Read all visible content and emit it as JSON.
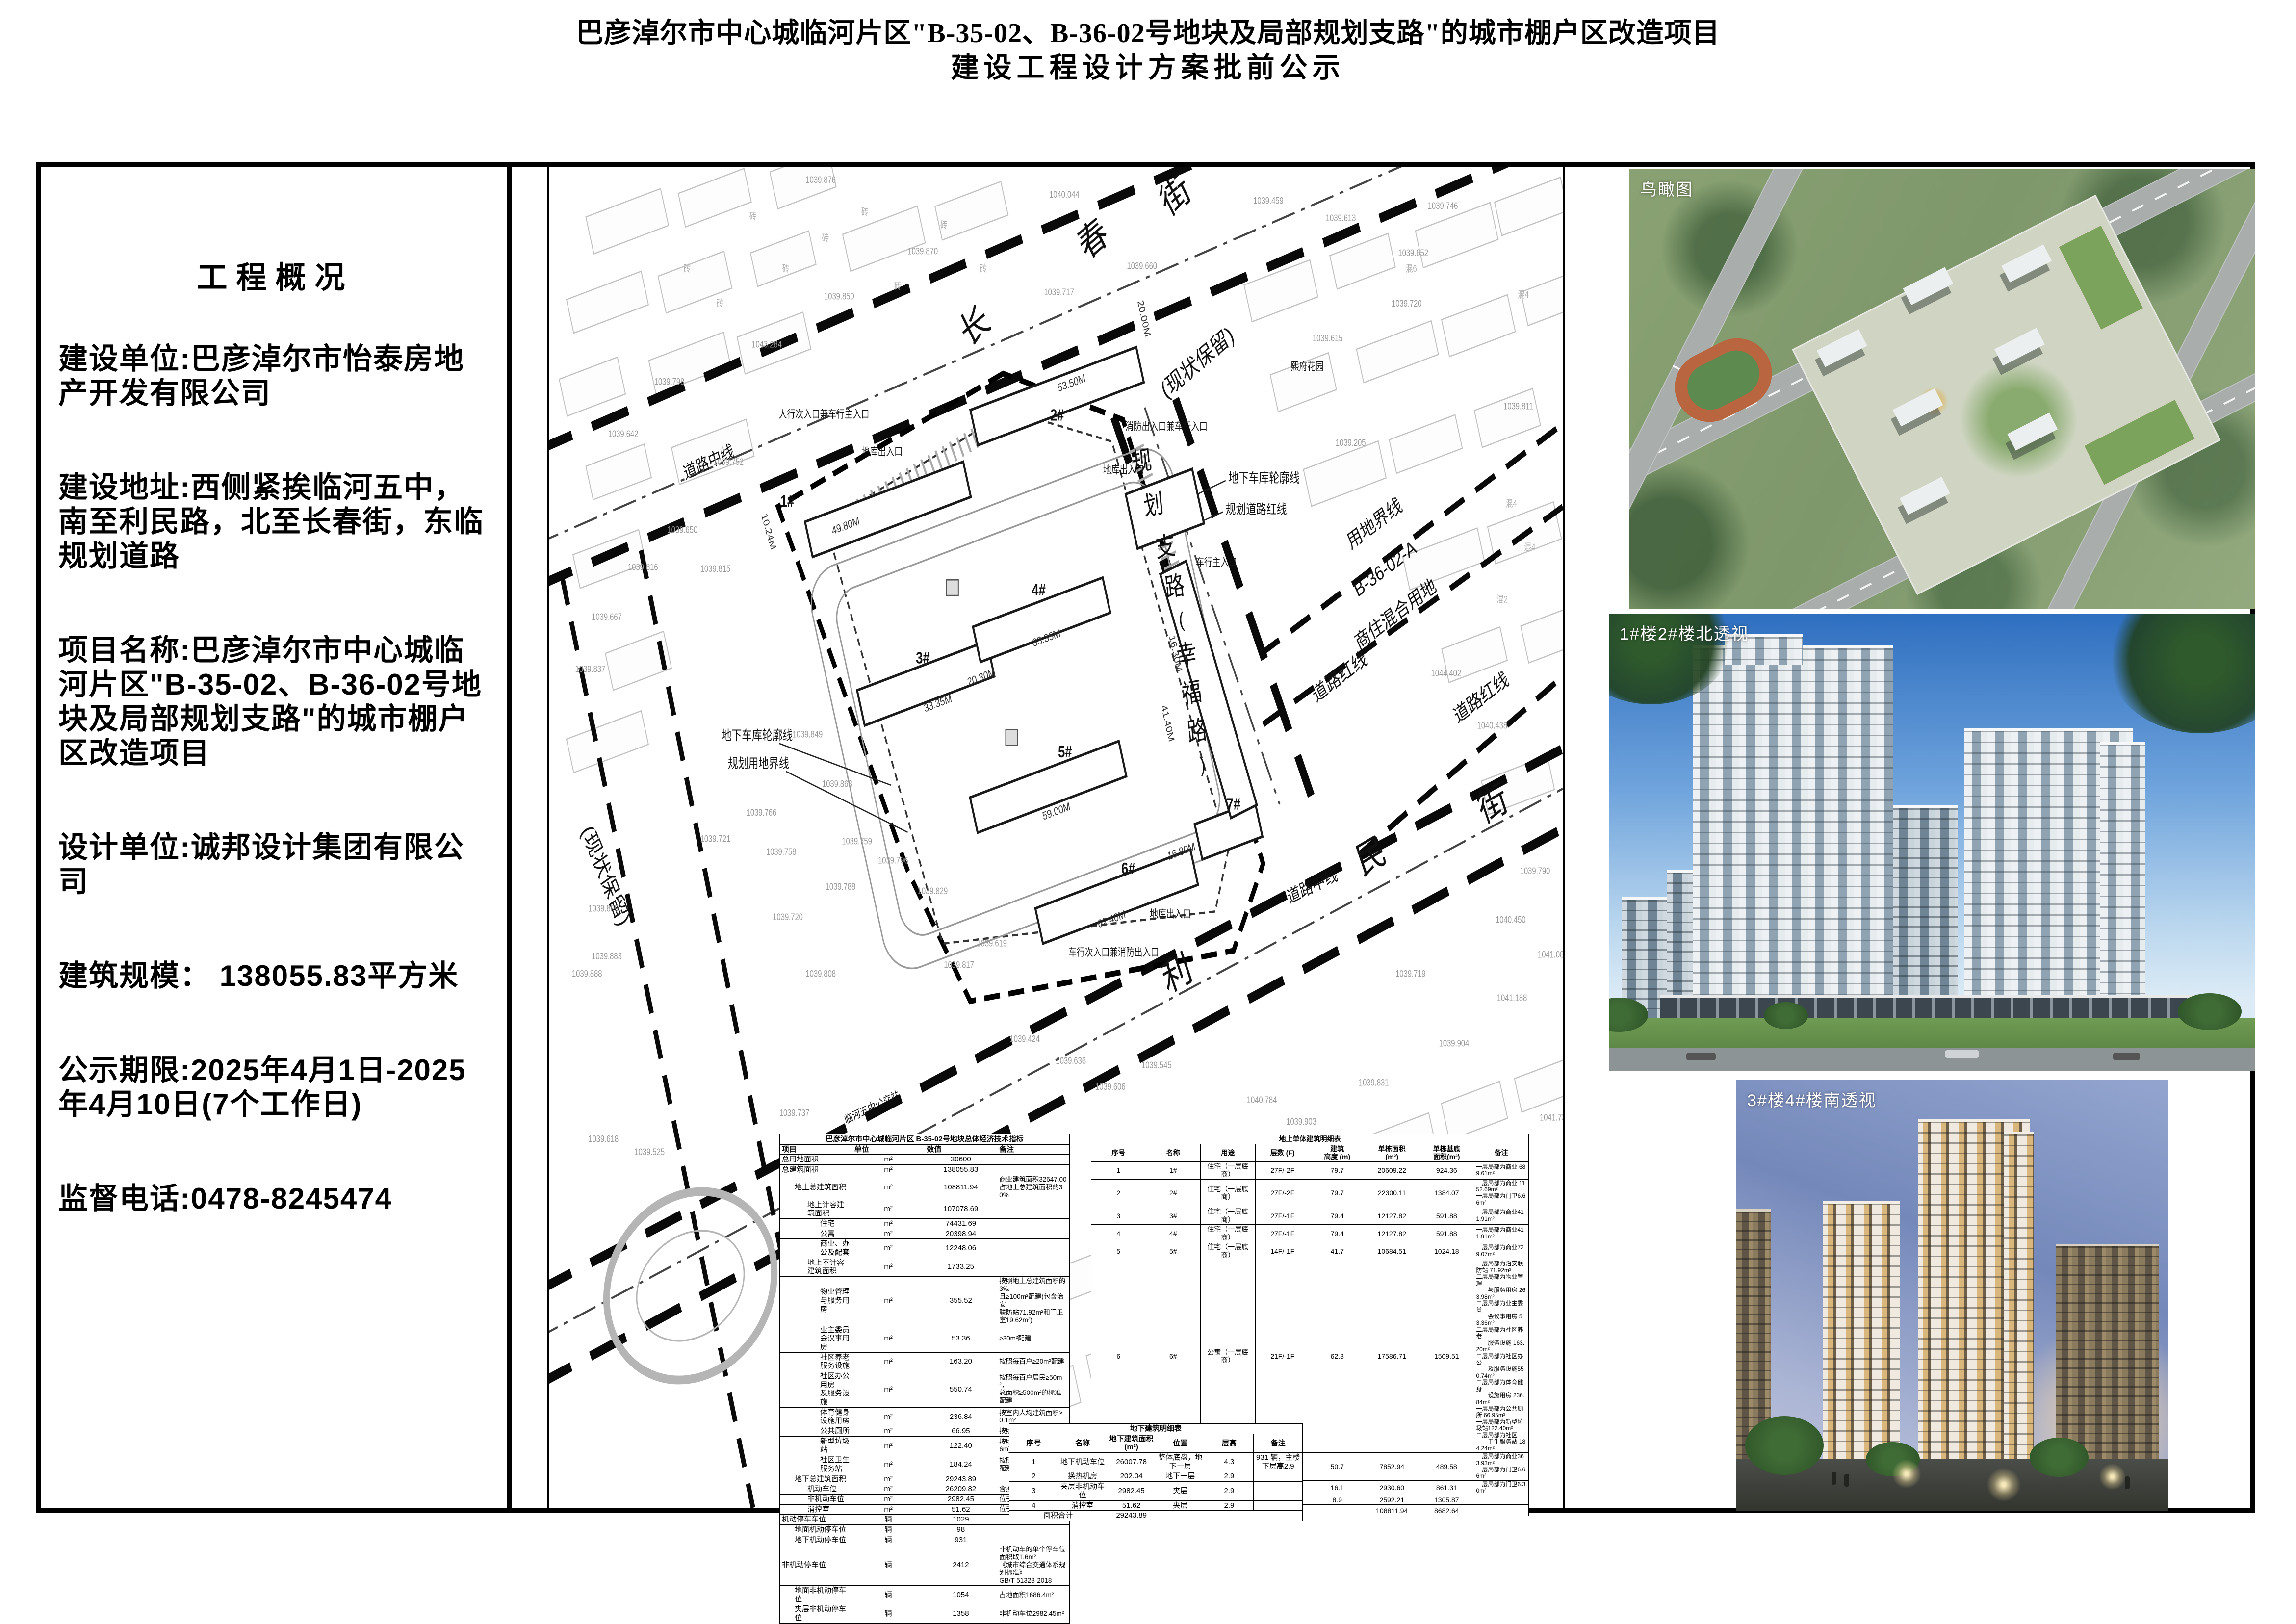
{
  "title": {
    "line1": "巴彦淖尔市中心城临河片区\"B-35-02、B-36-02号地块及局部规划支路\"的城市棚户区改造项目",
    "line2": "建设工程设计方案批前公示"
  },
  "overview": {
    "heading": "工程概况",
    "paragraphs": [
      "建设单位:巴彦淖尔市怡泰房地产开发有限公司",
      "建设地址:西侧紧挨临河五中，南至利民路，北至长春街，东临规划道路",
      "项目名称:巴彦淖尔市中心城临河片区\"B-35-02、B-36-02号地块及局部规划支路\"的城市棚户区改造项目",
      "设计单位:诚邦设计集团有限公司",
      "建筑规模： 138055.83平方米",
      "公示期限:2025年4月1日-2025年4月10日(7个工作日)",
      "监督电话:0478-8245474"
    ]
  },
  "renderings": [
    {
      "label": "鸟瞰图"
    },
    {
      "label": "1#楼2#楼北透视"
    },
    {
      "label": "3#楼4#楼南透视"
    }
  ],
  "tables": {
    "econ": {
      "title": "巴彦淖尔市中心城临河片区 B-35-02号地块总体经济技术指标",
      "headers": [
        "项目",
        "单位",
        "数值",
        "备注"
      ],
      "rows": [
        [
          0,
          "总用地面积",
          "m²",
          "30600",
          ""
        ],
        [
          0,
          "总建筑面积",
          "m²",
          "138055.83",
          ""
        ],
        [
          1,
          "地上总建筑面积",
          "m²",
          "108811.94",
          "商业建筑面积32647.00\n占地上总建筑面积的30%"
        ],
        [
          2,
          "地上计容建筑面积",
          "m²",
          "107078.69",
          ""
        ],
        [
          3,
          "住宅",
          "m²",
          "74431.69",
          ""
        ],
        [
          3,
          "公寓",
          "m²",
          "20398.94",
          ""
        ],
        [
          3,
          "商业、办公及配套",
          "m²",
          "12248.06",
          ""
        ],
        [
          2,
          "地上不计容建筑面积",
          "m²",
          "1733.25",
          ""
        ],
        [
          3,
          "物业管理与服务用房",
          "m²",
          "355.52",
          "按照地上总建筑面积的3‰\n且≥100m²配建(包含治安\n联防站71.92m²和门卫室19.62m²)"
        ],
        [
          3,
          "业主委员会议事用房",
          "m²",
          "53.36",
          "≥30m²配建"
        ],
        [
          3,
          "社区养老服务设施",
          "m²",
          "163.20",
          "按照每百户≥20m²配建"
        ],
        [
          3,
          "社区办公用房\n及服务设施",
          "m²",
          "550.74",
          "按照每百户居民≥50m²，\n总面积≥500m²的标准配建"
        ],
        [
          3,
          "体育健身设施用房",
          "m²",
          "236.84",
          "按室内人均建筑面积≥0.1m²"
        ],
        [
          3,
          "公共厕所",
          "m²",
          "66.95",
          "按照≥60m²配建"
        ],
        [
          3,
          "新型垃圾站",
          "m²",
          "122.40",
          "按照≥120m²配建(净高≥6m)"
        ],
        [
          3,
          "社区卫生服务站",
          "m²",
          "184.24",
          "按照建筑面积≥150m²配建"
        ],
        [
          1,
          "地下总建筑面积",
          "m²",
          "29243.89",
          ""
        ],
        [
          2,
          "机动车位",
          "m²",
          "26209.82",
          "含换热机房"
        ],
        [
          2,
          "非机动车位",
          "m²",
          "2982.45",
          "位于夹层"
        ],
        [
          2,
          "消控室",
          "m²",
          "51.62",
          "位于夹层"
        ],
        [
          0,
          "机动停车车位",
          "辆",
          "1029",
          ""
        ],
        [
          1,
          "地面机动停车位",
          "辆",
          "98",
          ""
        ],
        [
          1,
          "地下机动停车位",
          "辆",
          "931",
          ""
        ],
        [
          0,
          "非机动停车位",
          "辆",
          "2412",
          "非机动车的单个停车位面积取1.6m²\n《城市综合交通体系规划标准》\nGB/T 51328-2018"
        ],
        [
          1,
          "地面非机动停车位",
          "辆",
          "1054",
          "占地面积1686.4m²"
        ],
        [
          1,
          "夹层非机动停车位",
          "辆",
          "1358",
          "非机动车位2982.45m²"
        ],
        [
          0,
          "住宅户数",
          "户",
          "702",
          ""
        ],
        [
          0,
          "住宅居住人数",
          "人",
          "2247",
          "每户3.2 人"
        ],
        [
          0,
          "公寓户数",
          "户",
          "294",
          ""
        ],
        [
          0,
          "容积率",
          "/",
          "3.50",
          "≤3.5"
        ],
        [
          0,
          "绿地面积",
          "m²",
          "8009.45",
          ""
        ],
        [
          0,
          "绿地率",
          "%",
          "26.2",
          "≥26%"
        ],
        [
          0,
          "建筑占地",
          "m²",
          "8682.64",
          ""
        ],
        [
          0,
          "建筑密度",
          "%",
          "28.4",
          "≤35%"
        ]
      ]
    },
    "above": {
      "title": "地上单体建筑明细表",
      "headers": [
        "序号",
        "名称",
        "用途",
        "层数 (F)",
        "建筑\n高度 (m)",
        "单栋面积\n(m²)",
        "单栋基底\n面积(m²)",
        "备注"
      ],
      "rows": [
        [
          "1",
          "1#",
          "住宅（一层底商）",
          "27F/-2F",
          "79.7",
          "20609.22",
          "924.36",
          "一层局部为商业 689.61m²"
        ],
        [
          "2",
          "2#",
          "住宅（一层底商）",
          "27F/-2F",
          "79.7",
          "22300.11",
          "1384.07",
          "一层局部为商业 1152.69m²\n一层局部为门卫6.66m²"
        ],
        [
          "3",
          "3#",
          "住宅（一层底商）",
          "27F/-1F",
          "79.4",
          "12127.82",
          "591.88",
          "一层局部为商业411.91m²"
        ],
        [
          "4",
          "4#",
          "住宅（一层底商）",
          "27F/-1F",
          "79.4",
          "12127.82",
          "591.88",
          "一层局部为商业411.91m²"
        ],
        [
          "5",
          "5#",
          "住宅（一层底商）",
          "14F/-1F",
          "41.7",
          "10684.51",
          "1024.18",
          "一层局部为商业729.07m²"
        ],
        [
          "6",
          "6#",
          "公寓（一层底商）",
          "21F/-1F",
          "62.3",
          "17586.71",
          "1509.51",
          "一层局部为治安联防站 71.92m²\n二层局部为物业管理\n　　与服务用房 263.98m²\n二层局部为业主委员\n　　会议事用房 53.36m²\n二层局部为社区养老\n　　服务设施 163.20m²\n二层局部为社区办公\n　　及服务设施550.74m²\n二层局部为体育健身\n　　设施用房 236.84m²\n一层局部为公共厕所 66.95m²\n一层局部为新型垃圾站122.40m²\n二层局部为社区\n　　卫生服务站 184.24m²"
        ],
        [
          "7",
          "7#",
          "公寓（一层底商）",
          "17F/-2F",
          "50.7",
          "7852.94",
          "489.58",
          "一层局部为商业363.93m²\n一层局部为门卫6.66m²"
        ],
        [
          "8",
          "S1",
          "商业配套用房",
          "4F",
          "16.1",
          "2930.60",
          "861.31",
          "一层局部为门卫6.30m²"
        ],
        [
          "9",
          "S2",
          "商业配套用房",
          "2F/-2F",
          "8.9",
          "2592.21",
          "1305.87",
          ""
        ]
      ],
      "total_label": "面积合计",
      "total_area": "108811.94",
      "total_base": "8682.64"
    },
    "under": {
      "title": "地下建筑明细表",
      "headers": [
        "序号",
        "名称",
        "地下建筑面积(m²)",
        "位置",
        "层高",
        "备注"
      ],
      "rows": [
        [
          "1",
          "地下机动车位",
          "26007.78",
          "整体底盘，地下一层",
          "4.3",
          "931 辆，主楼下层高2.9"
        ],
        [
          "2",
          "换热机房",
          "202.04",
          "地下一层",
          "2.9",
          ""
        ],
        [
          "3",
          "夹层非机动车位",
          "2982.45",
          "夹层",
          "2.9",
          ""
        ],
        [
          "4",
          "消控室",
          "51.62",
          "夹层",
          "2.9",
          ""
        ]
      ],
      "total_label": "面积合计",
      "total_area": "29243.89"
    }
  },
  "plan_labels": [
    [
      "长",
      655,
      195,
      -33,
      "big"
    ],
    [
      "春",
      835,
      95,
      -33,
      "big"
    ],
    [
      "街",
      960,
      45,
      -33,
      "big"
    ],
    [
      "利",
      960,
      940,
      -24,
      "big"
    ],
    [
      "民",
      1255,
      805,
      -24,
      "big"
    ],
    [
      "街",
      1440,
      745,
      -24,
      "big"
    ],
    [
      "规",
      902,
      348,
      -8,
      "med"
    ],
    [
      "划",
      920,
      398,
      -8,
      "med"
    ],
    [
      "支",
      938,
      446,
      -8,
      "med"
    ],
    [
      "路",
      952,
      492,
      -8,
      "med"
    ],
    [
      "(",
      962,
      528,
      -8,
      "par"
    ],
    [
      "幸",
      970,
      570,
      -8,
      "med"
    ],
    [
      "福",
      978,
      614,
      -8,
      "med"
    ],
    [
      "路",
      986,
      658,
      -8,
      "med"
    ],
    [
      ")",
      994,
      694,
      -8,
      "par"
    ],
    [
      "(现状保留)",
      990,
      232,
      -33,
      "cz"
    ],
    [
      "(现状保留)",
      78,
      818,
      62,
      "cz"
    ],
    [
      "道路中线",
      245,
      345,
      -20,
      "note"
    ],
    [
      "道路中线",
      1162,
      832,
      -20,
      "note"
    ],
    [
      "用地界线",
      1258,
      416,
      -30,
      "m2"
    ],
    [
      "B-36-02-A",
      1274,
      468,
      -30,
      "m2"
    ],
    [
      "商住混合用地",
      1290,
      520,
      -30,
      "m2"
    ],
    [
      "道路红线",
      1205,
      592,
      -30,
      "m2"
    ],
    [
      "道路红线",
      1420,
      616,
      -30,
      "m2"
    ],
    [
      "地下车库轮廓线",
      1032,
      362,
      0,
      "callout"
    ],
    [
      "规划道路红线",
      1028,
      398,
      0,
      "callout"
    ],
    [
      "地下车库轮廓线",
      262,
      658,
      0,
      "callout"
    ],
    [
      "规划用地界线",
      272,
      690,
      0,
      "callout"
    ],
    [
      "熙府花园",
      1152,
      233,
      0,
      "tiny"
    ],
    [
      "1#",
      362,
      390,
      0,
      "bld"
    ],
    [
      "2#",
      772,
      291,
      0,
      "bld"
    ],
    [
      "3#",
      568,
      570,
      0,
      "bld"
    ],
    [
      "4#",
      744,
      492,
      0,
      "bld"
    ],
    [
      "5#",
      784,
      678,
      0,
      "bld"
    ],
    [
      "6#",
      880,
      812,
      0,
      "bld"
    ],
    [
      "7#",
      1040,
      738,
      0,
      "bld"
    ],
    [
      "人行次入口兼车行主入口",
      418,
      288,
      0,
      "tiny"
    ],
    [
      "消防出入口兼车行入口",
      938,
      302,
      0,
      "tiny"
    ],
    [
      "车行主入口",
      1014,
      458,
      0,
      "tiny"
    ],
    [
      "车行次入口兼消防出入口",
      858,
      906,
      0,
      "tiny"
    ],
    [
      "地库出入口",
      506,
      331,
      0,
      "tiny"
    ],
    [
      "地库出入口",
      873,
      352,
      0,
      "tiny"
    ],
    [
      "地库出入口",
      944,
      862,
      0,
      "tiny"
    ],
    [
      "临河五中公交站",
      492,
      1084,
      -20,
      "tiny"
    ],
    [
      "53.50M",
      795,
      252,
      -16,
      "dim"
    ],
    [
      "49.80M",
      452,
      416,
      -16,
      "dim"
    ],
    [
      "33.35M",
      592,
      620,
      -16,
      "dim"
    ],
    [
      "33.35M",
      757,
      545,
      -16,
      "dim"
    ],
    [
      "20.30M",
      658,
      590,
      -16,
      "dim"
    ],
    [
      "59.00M",
      772,
      744,
      -16,
      "dim"
    ],
    [
      "62.40M",
      856,
      868,
      -16,
      "dim"
    ],
    [
      "16.80M",
      962,
      790,
      -16,
      "dim"
    ],
    [
      "41.40M",
      936,
      640,
      74,
      "dim"
    ],
    [
      "16.30M",
      948,
      560,
      74,
      "dim"
    ],
    [
      "20.00M",
      900,
      175,
      74,
      "dim"
    ],
    [
      "10.24M",
      330,
      420,
      70,
      "dim"
    ],
    [
      "1039.876",
      390,
      18,
      0,
      "spot"
    ],
    [
      "1040.044",
      760,
      35,
      0,
      "spot"
    ],
    [
      "1039.459",
      1070,
      42,
      0,
      "spot"
    ],
    [
      "1039.746",
      1335,
      48,
      0,
      "spot"
    ],
    [
      "1039.613",
      1180,
      62,
      0,
      "spot"
    ],
    [
      "1039.652",
      1290,
      102,
      0,
      "spot"
    ],
    [
      "1039.660",
      878,
      117,
      0,
      "spot"
    ],
    [
      "1039.717",
      752,
      147,
      0,
      "spot"
    ],
    [
      "1039.870",
      545,
      100,
      0,
      "spot"
    ],
    [
      "1039.850",
      418,
      152,
      0,
      "spot"
    ],
    [
      "1043.284",
      308,
      207,
      0,
      "spot"
    ],
    [
      "1039.798",
      160,
      250,
      0,
      "spot"
    ],
    [
      "1039.642",
      90,
      310,
      0,
      "spot"
    ],
    [
      "1039.752",
      250,
      342,
      0,
      "spot"
    ],
    [
      "1039.650",
      180,
      420,
      0,
      "spot"
    ],
    [
      "1039.816",
      120,
      463,
      0,
      "spot"
    ],
    [
      "1039.667",
      65,
      520,
      0,
      "spot"
    ],
    [
      "1039.837",
      40,
      580,
      0,
      "spot"
    ],
    [
      "1039.815",
      230,
      465,
      0,
      "spot"
    ],
    [
      "1039.849",
      370,
      655,
      0,
      "spot"
    ],
    [
      "1039.868",
      415,
      712,
      0,
      "spot"
    ],
    [
      "1039.766",
      300,
      745,
      0,
      "spot"
    ],
    [
      "1039.758",
      330,
      790,
      0,
      "spot"
    ],
    [
      "1039.721",
      230,
      775,
      0,
      "spot"
    ],
    [
      "1039.759",
      445,
      778,
      0,
      "spot"
    ],
    [
      "1039.796",
      500,
      800,
      0,
      "spot"
    ],
    [
      "1039.788",
      420,
      830,
      0,
      "spot"
    ],
    [
      "1039.829",
      560,
      835,
      0,
      "spot"
    ],
    [
      "1039.720",
      340,
      865,
      0,
      "spot"
    ],
    [
      "1039.817",
      600,
      920,
      0,
      "spot"
    ],
    [
      "1039.619",
      650,
      895,
      0,
      "spot"
    ],
    [
      "1039.424",
      700,
      1005,
      0,
      "spot"
    ],
    [
      "1039.636",
      770,
      1030,
      0,
      "spot"
    ],
    [
      "1039.606",
      830,
      1060,
      0,
      "spot"
    ],
    [
      "1039.545",
      900,
      1035,
      0,
      "spot"
    ],
    [
      "1040.784",
      1060,
      1075,
      0,
      "spot"
    ],
    [
      "1039.903",
      1120,
      1100,
      0,
      "spot"
    ],
    [
      "1039.831",
      1230,
      1055,
      0,
      "spot"
    ],
    [
      "1039.205",
      1195,
      320,
      0,
      "spot"
    ],
    [
      "1039.811",
      1450,
      278,
      0,
      "spot"
    ],
    [
      "1039.615",
      1160,
      200,
      0,
      "spot"
    ],
    [
      "1039.720",
      1280,
      160,
      0,
      "spot"
    ],
    [
      "1044.402",
      1340,
      585,
      0,
      "spot"
    ],
    [
      "1040.438",
      1410,
      645,
      0,
      "spot"
    ],
    [
      "1039.790",
      1475,
      812,
      0,
      "spot"
    ],
    [
      "1040.450",
      1438,
      868,
      0,
      "spot"
    ],
    [
      "1041.087",
      1502,
      908,
      0,
      "spot"
    ],
    [
      "1039.719",
      1286,
      930,
      0,
      "spot"
    ],
    [
      "1041.188",
      1440,
      958,
      0,
      "spot"
    ],
    [
      "1039.904",
      1352,
      1010,
      0,
      "spot"
    ],
    [
      "1041.738",
      1505,
      1095,
      0,
      "spot"
    ],
    [
      "1039.737",
      350,
      1090,
      0,
      "spot"
    ],
    [
      "1039.755",
      440,
      1120,
      0,
      "spot"
    ],
    [
      "1039.618",
      60,
      1120,
      0,
      "spot"
    ],
    [
      "1039.525",
      130,
      1135,
      0,
      "spot"
    ],
    [
      "1039.888",
      35,
      930,
      0,
      "spot"
    ],
    [
      "1039.808",
      390,
      930,
      0,
      "spot"
    ],
    [
      "1039.809",
      60,
      855,
      0,
      "spot"
    ],
    [
      "1039.883",
      65,
      910,
      0,
      "spot"
    ],
    [
      "砖",
      310,
      60,
      0,
      "mat"
    ],
    [
      "砖",
      360,
      120,
      0,
      "mat"
    ],
    [
      "砖",
      420,
      85,
      0,
      "mat"
    ],
    [
      "砖",
      480,
      55,
      0,
      "mat"
    ],
    [
      "砖",
      530,
      140,
      0,
      "mat"
    ],
    [
      "砖",
      210,
      120,
      0,
      "mat"
    ],
    [
      "砖",
      600,
      70,
      0,
      "mat"
    ],
    [
      "砖",
      660,
      120,
      0,
      "mat"
    ],
    [
      "砖",
      260,
      160,
      0,
      "mat"
    ],
    [
      "混4",
      1480,
      150,
      0,
      "mat"
    ],
    [
      "混4",
      1462,
      390,
      0,
      "mat"
    ],
    [
      "混4",
      1490,
      440,
      0,
      "mat"
    ],
    [
      "混2",
      1448,
      500,
      0,
      "mat"
    ],
    [
      "混6",
      1310,
      120,
      0,
      "mat"
    ]
  ]
}
